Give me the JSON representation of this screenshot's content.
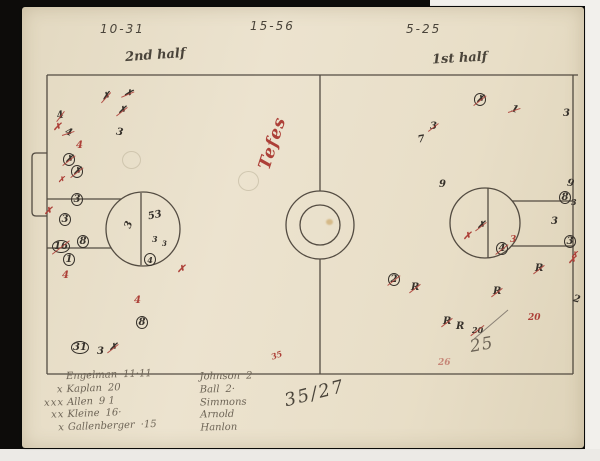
{
  "colors": {
    "ink": "#35302a",
    "red": "#ad4038",
    "pencil": "#6e6557",
    "pencil_dark": "#4a443a",
    "paper": "#e8dfca",
    "background": "#0d0c0a"
  },
  "header": {
    "score_left": "10-31",
    "score_mid": "15-56",
    "score_right": "5-25",
    "half_left": "2nd half",
    "half_right": "1st half"
  },
  "notes": {
    "red_script": "Tefes",
    "big_score": "35/27",
    "corner_note": "25",
    "small_red_note": "35"
  },
  "roster_left": [
    {
      "pre": "",
      "name": "Engelman",
      "num": "11·11"
    },
    {
      "pre": "x",
      "name": "Kaplan",
      "num": "20"
    },
    {
      "pre": "xxx",
      "name": "Allen",
      "num": "9 1"
    },
    {
      "pre": "xx",
      "name": "Kleine",
      "num": "16·"
    },
    {
      "pre": "x",
      "name": "Gallenberger",
      "num": "·15"
    }
  ],
  "roster_mid": [
    {
      "name": "Johnson",
      "num": "2"
    },
    {
      "name": "Ball",
      "num": "2·"
    },
    {
      "name": "Simmons",
      "num": ""
    },
    {
      "name": "Arnold",
      "num": ""
    },
    {
      "name": "Hanlon",
      "num": ""
    }
  ],
  "marks": [
    {
      "x": 80,
      "y": 85,
      "g": "✗",
      "c": "i",
      "s": 1,
      "r": -10
    },
    {
      "x": 102,
      "y": 82,
      "g": "✗",
      "c": "i",
      "s": 1,
      "r": 15
    },
    {
      "x": 96,
      "y": 99,
      "g": "✗",
      "c": "i",
      "s": 1
    },
    {
      "x": 94,
      "y": 121,
      "g": "3",
      "c": "i",
      "r": 10
    },
    {
      "x": 35,
      "y": 104,
      "g": "4",
      "c": "i",
      "s": 1,
      "r": -15
    },
    {
      "x": 31,
      "y": 116,
      "g": "✗",
      "c": "r"
    },
    {
      "x": 43,
      "y": 121,
      "g": "4",
      "c": "i",
      "s": 1,
      "r": 20
    },
    {
      "x": 54,
      "y": 134,
      "g": "4",
      "c": "r"
    },
    {
      "x": 41,
      "y": 146,
      "g": "✗",
      "c": "i",
      "circ": 1,
      "s": 1
    },
    {
      "x": 49,
      "y": 158,
      "g": "✗",
      "c": "i",
      "circ": 1,
      "s": 1
    },
    {
      "x": 36,
      "y": 168,
      "g": "✗",
      "c": "r",
      "f": 8
    },
    {
      "x": 49,
      "y": 186,
      "g": "3",
      "c": "i",
      "circ": 1
    },
    {
      "x": 22,
      "y": 200,
      "g": "✗",
      "c": "r"
    },
    {
      "x": 37,
      "y": 206,
      "g": "3",
      "c": "i",
      "circ": 1
    },
    {
      "x": 30,
      "y": 233,
      "g": "16",
      "c": "i",
      "circ": 1,
      "s": 1
    },
    {
      "x": 55,
      "y": 228,
      "g": "8",
      "c": "i",
      "circ": 1
    },
    {
      "x": 41,
      "y": 246,
      "g": "1",
      "c": "i",
      "circ": 1
    },
    {
      "x": 40,
      "y": 264,
      "g": "4",
      "c": "r"
    },
    {
      "x": 112,
      "y": 289,
      "g": "4",
      "c": "r"
    },
    {
      "x": 114,
      "y": 309,
      "g": "8",
      "c": "i",
      "circ": 1
    },
    {
      "x": 49,
      "y": 334,
      "g": "31",
      "c": "i",
      "circ": 1
    },
    {
      "x": 75,
      "y": 340,
      "g": "3",
      "c": "i"
    },
    {
      "x": 87,
      "y": 336,
      "g": "✗",
      "c": "i",
      "s": 1
    },
    {
      "x": 104,
      "y": 213,
      "g": "3",
      "c": "i",
      "r": -70
    },
    {
      "x": 126,
      "y": 204,
      "g": "53",
      "c": "i",
      "r": -12
    },
    {
      "x": 130,
      "y": 228,
      "g": "3",
      "c": "i",
      "f": 8
    },
    {
      "x": 140,
      "y": 233,
      "g": "3",
      "c": "i",
      "f": 7
    },
    {
      "x": 122,
      "y": 246,
      "g": "4",
      "c": "i",
      "circ": 1,
      "f": 8
    },
    {
      "x": 155,
      "y": 258,
      "g": "✗",
      "c": "r"
    },
    {
      "x": 249,
      "y": 344,
      "g": "35",
      "c": "r",
      "f": 8,
      "r": -20
    },
    {
      "x": 366,
      "y": 266,
      "g": "2",
      "c": "i",
      "circ": 1,
      "s": 1
    },
    {
      "x": 389,
      "y": 276,
      "g": "R",
      "c": "i",
      "s": 1
    },
    {
      "x": 452,
      "y": 86,
      "g": "✗",
      "c": "i",
      "circ": 1,
      "s": 1
    },
    {
      "x": 489,
      "y": 98,
      "g": "1",
      "c": "i",
      "s": 1,
      "r": 20
    },
    {
      "x": 541,
      "y": 102,
      "g": "3",
      "c": "i"
    },
    {
      "x": 408,
      "y": 115,
      "g": "3",
      "c": "i",
      "s": 1
    },
    {
      "x": 396,
      "y": 128,
      "g": "7",
      "c": "i",
      "r": -10
    },
    {
      "x": 417,
      "y": 173,
      "g": "9",
      "c": "i"
    },
    {
      "x": 545,
      "y": 172,
      "g": "9",
      "c": "i",
      "r": 10
    },
    {
      "x": 537,
      "y": 184,
      "g": "8",
      "c": "i",
      "circ": 1
    },
    {
      "x": 549,
      "y": 191,
      "g": "3",
      "c": "i",
      "f": 8
    },
    {
      "x": 455,
      "y": 214,
      "g": "✗",
      "c": "i",
      "s": 1
    },
    {
      "x": 441,
      "y": 225,
      "g": "✗",
      "c": "r"
    },
    {
      "x": 474,
      "y": 235,
      "g": "4",
      "c": "i",
      "circ": 1,
      "s": 1
    },
    {
      "x": 488,
      "y": 229,
      "g": "3",
      "c": "r",
      "f": 9
    },
    {
      "x": 529,
      "y": 210,
      "g": "3",
      "c": "i"
    },
    {
      "x": 542,
      "y": 228,
      "g": "3",
      "c": "i",
      "circ": 1
    },
    {
      "x": 549,
      "y": 243,
      "g": "✗",
      "c": "r",
      "f": 8
    },
    {
      "x": 513,
      "y": 257,
      "g": "R",
      "c": "i",
      "s": 1
    },
    {
      "x": 546,
      "y": 249,
      "g": "✗",
      "c": "r"
    },
    {
      "x": 471,
      "y": 280,
      "g": "R",
      "c": "i",
      "s": 1
    },
    {
      "x": 551,
      "y": 288,
      "g": "2",
      "c": "i",
      "r": 15
    },
    {
      "x": 421,
      "y": 310,
      "g": "R",
      "c": "i",
      "s": 1
    },
    {
      "x": 434,
      "y": 315,
      "g": "R",
      "c": "i"
    },
    {
      "x": 450,
      "y": 319,
      "g": "20",
      "c": "i",
      "s": 1,
      "f": 8
    },
    {
      "x": 506,
      "y": 307,
      "g": "20",
      "c": "r",
      "f": 9
    },
    {
      "x": 416,
      "y": 352,
      "g": "26",
      "c": "r",
      "f": 9,
      "faint": 1
    }
  ]
}
